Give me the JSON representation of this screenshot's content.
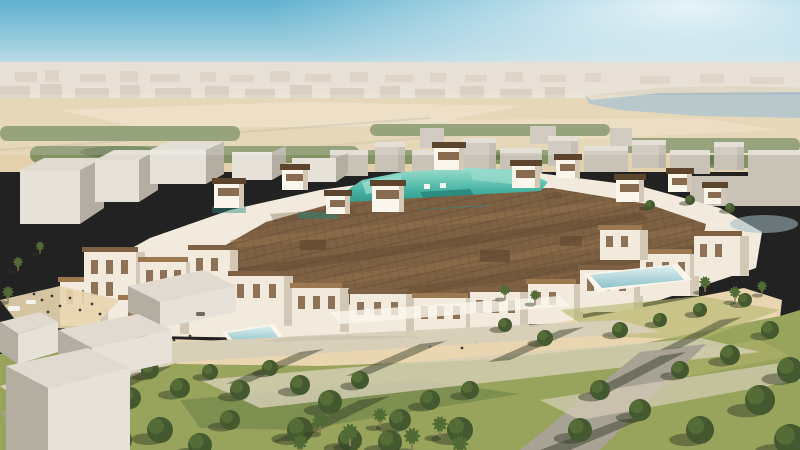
{
  "meta": {
    "type": "architectural-aerial-rendering",
    "subject": "Aerial rendering of a desert low-rise district with a central teal stadium bowl, brown rooftop souq canopy, white courtyard buildings, reflecting pools and a landscaped park",
    "visible_text": "none"
  },
  "colors": {
    "sky_top": "#5fb1cf",
    "sky_mid": "#a9d3e2",
    "sky_horizon": "#eff0ec",
    "glow": "#ffffff",
    "haze_city": "#e9e0d5",
    "haze_city_dark": "#d6cabb",
    "water": "#a4bbc3",
    "desert": "#e3d0ac",
    "desert_light": "#eedfc4",
    "greenbelt": "#7b8d5d",
    "greenbelt_dark": "#5e7348",
    "massing_far": "#c9c2b7",
    "massing_far_top": "#e0dad0",
    "massing_near": "#e6e2da",
    "massing_shade": "#b4aea2",
    "bldg_lit": "#f2ebdd",
    "bldg_shade": "#d3c8b5",
    "bldg_white": "#faf6ec",
    "window_brown": "#7c5d3f",
    "roof": "#7e6043",
    "roof_dark": "#5d452d",
    "roof_light": "#9b784f",
    "teal": "#45b2a1",
    "teal_light": "#9addcd",
    "teal_dark": "#2a867c",
    "plaza": "#e9d6b0",
    "pool_light": "#ddefee",
    "pool": "#8fc2cc",
    "lawn": "#98a35b",
    "lawn_light": "#b4b56e",
    "lawn_dark": "#74874c",
    "path": "#d7cfb8",
    "road": "#a8a294",
    "road_dark": "#6f6c5c",
    "shadow": "rgba(44,54,36,0.45)",
    "tree": "#44592f",
    "tree_dark": "#2e4124",
    "tree_light": "#647c3e",
    "palm": "#506c34",
    "trunk": "#8d7c5a",
    "people": "#3c3c38",
    "car": "#f5f3ee"
  },
  "scene": {
    "regions": [
      {
        "name": "sky",
        "color": "sky_top"
      },
      {
        "name": "sun-haze",
        "color": "glow"
      },
      {
        "name": "distant-skyline",
        "color": "haze_city"
      },
      {
        "name": "bay-water",
        "color": "water"
      },
      {
        "name": "desert-plain",
        "color": "desert"
      },
      {
        "name": "greenbelt",
        "color": "greenbelt"
      },
      {
        "name": "background-city-blocks",
        "color": "massing_far"
      },
      {
        "name": "white-context-blocks",
        "color": "massing_near"
      },
      {
        "name": "stadium-district",
        "color": "bldg_lit"
      },
      {
        "name": "rooftop-souq-canopy",
        "color": "roof"
      },
      {
        "name": "stadium-bowl",
        "color": "teal"
      },
      {
        "name": "rooftop-towers",
        "color": "bldg_white"
      },
      {
        "name": "plaza",
        "color": "plaza"
      },
      {
        "name": "reflecting-pool",
        "color": "pool"
      },
      {
        "name": "courtyard-pool",
        "color": "pool"
      },
      {
        "name": "pond",
        "color": "water"
      },
      {
        "name": "park-lawn",
        "color": "lawn"
      },
      {
        "name": "park-paths",
        "color": "path"
      },
      {
        "name": "park-trees",
        "color": "tree"
      },
      {
        "name": "palm-trees",
        "color": "palm"
      },
      {
        "name": "foreground-massing-blocks",
        "color": "massing_near"
      },
      {
        "name": "vehicles",
        "color": "car"
      },
      {
        "name": "pedestrians",
        "color": "people"
      }
    ]
  }
}
